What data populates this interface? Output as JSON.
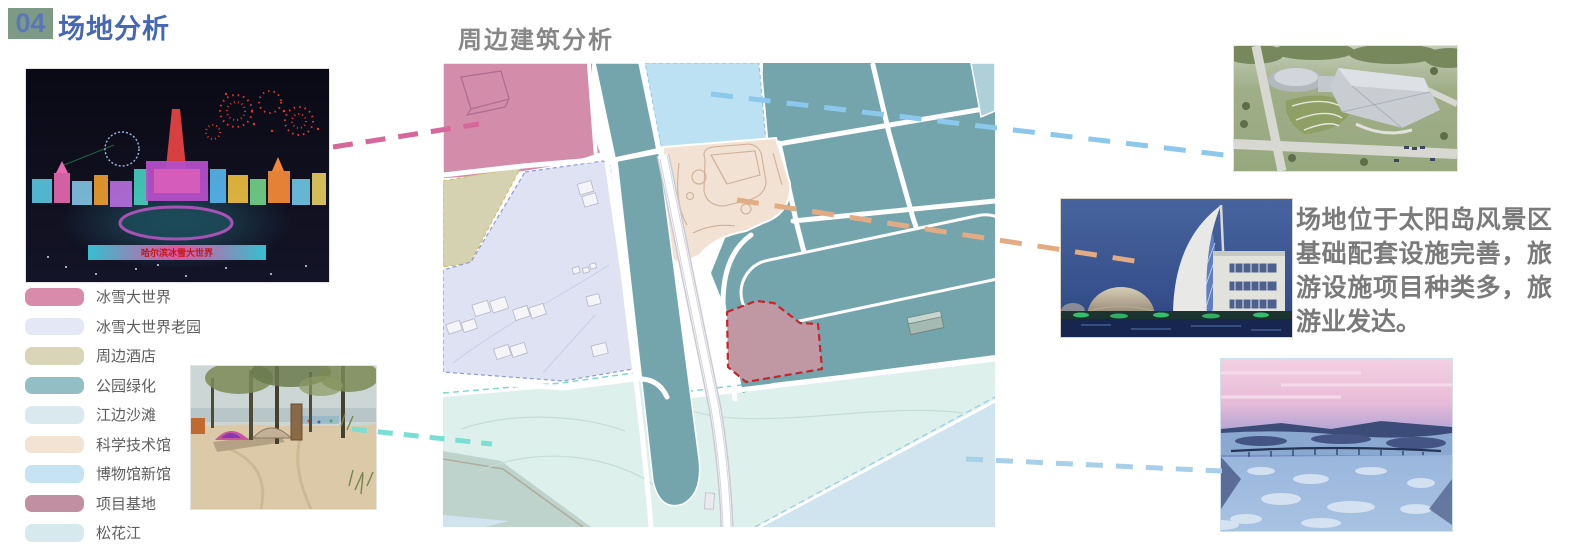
{
  "header": {
    "badge_number": "04",
    "title": "场地分析",
    "badge_bg": "#7d9a86",
    "title_color": "#4667b2"
  },
  "map_section": {
    "title": "周边建筑分析",
    "title_color": "#878787"
  },
  "legend": {
    "items": [
      {
        "label": "冰雪大世界",
        "color": "#d98bac",
        "style": "background:#d98bac"
      },
      {
        "label": "冰雪大世界老园",
        "color": "#e3e7f6",
        "style": "background:#e3e7f6"
      },
      {
        "label": "周边酒店",
        "color": "#d8d5b8",
        "style": "background:#d8d5b8"
      },
      {
        "label": "公园绿化",
        "color": "#93bfc4",
        "style": "background:#93bfc4"
      },
      {
        "label": "江边沙滩",
        "color": "#d9e9ed",
        "style": "background:#d9e9ed"
      },
      {
        "label": "科学技术馆",
        "color": "#f3e3d3",
        "style": "background:#f3e3d3"
      },
      {
        "label": "博物馆新馆",
        "color": "#c5e3f2",
        "style": "background:#c5e3f2"
      },
      {
        "label": "项目基地",
        "color": "#c18fa2",
        "style": "background:#c18fa2"
      },
      {
        "label": "松花江",
        "color": "#d6e9ec",
        "style": "background:#d6e9ec"
      }
    ]
  },
  "description": {
    "text": "场地位于太阳岛风景区基础配套设施完善，旅游设施项目种类多，旅游业发达。",
    "color": "#7a7a7a"
  },
  "photos": {
    "ice_world_banner": "哈尔滨冰雪大世界"
  },
  "map_colors": {
    "park_green": "#74a5ad",
    "ice_world_zone": "#d38caa",
    "old_park_zone": "#dee2f2",
    "hotel_zone": "#d5d2b2",
    "beach_zone": "#def0ec",
    "science_museum_zone": "#f1e2d3",
    "museum_new_zone": "#bce1f2",
    "project_site_fill": "#bf98a4",
    "project_site_border": "#c2262e",
    "river": "#cfe4ef"
  },
  "connectors": [
    {
      "name": "ice-world-link",
      "color": "#d5679b"
    },
    {
      "name": "museum-new-link",
      "color": "#8cc7ec"
    },
    {
      "name": "science-museum-link",
      "color": "#e2ab83"
    },
    {
      "name": "beach-link",
      "color": "#7adfd3"
    },
    {
      "name": "river-link",
      "color": "#a7cfe7"
    }
  ]
}
